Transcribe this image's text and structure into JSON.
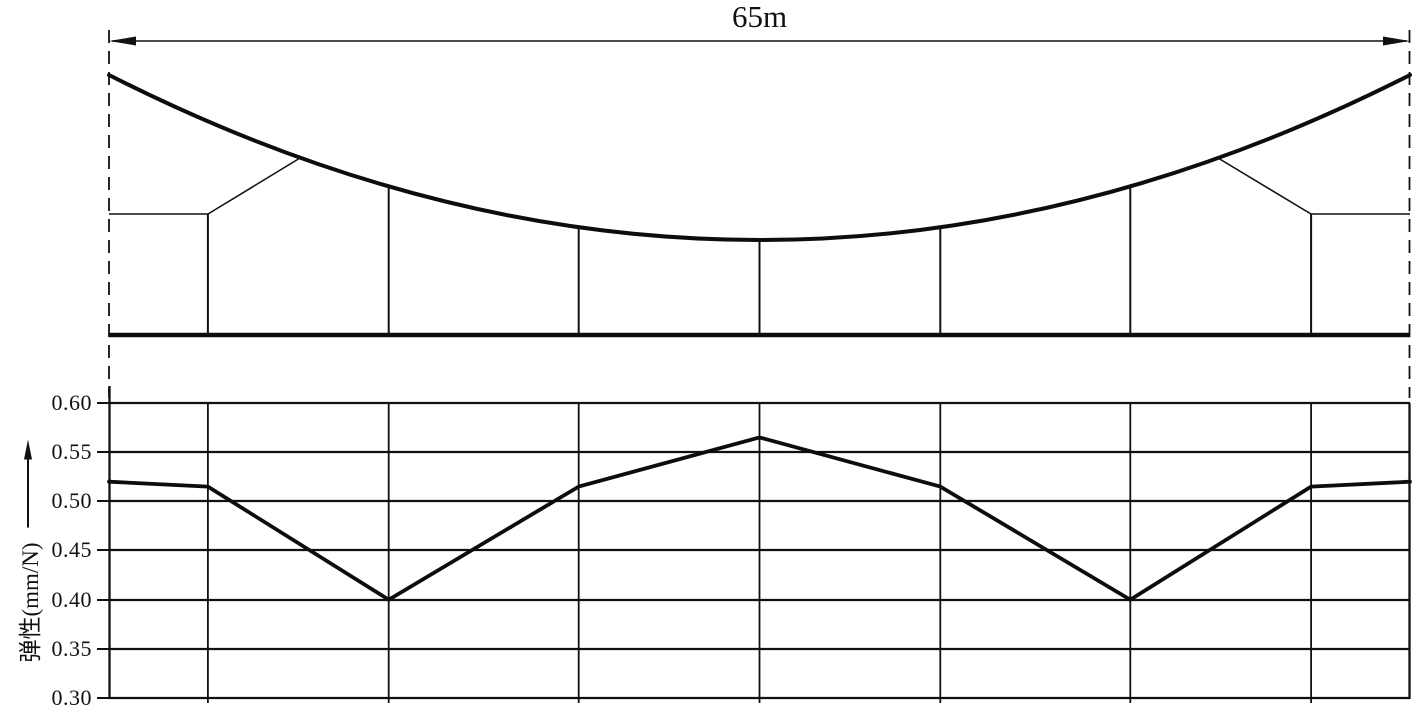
{
  "diagram": {
    "span_label": "65m",
    "dropper_fractions": [
      0.215,
      0.361,
      0.5,
      0.639,
      0.785
    ],
    "stitch_dropper_fractions": [
      0.076,
      0.924
    ]
  },
  "chart_data": {
    "type": "line",
    "title": "",
    "xlabel": "",
    "ylabel": "弹性(mm/N)",
    "ylim": [
      0.3,
      0.6
    ],
    "ytick_labels": [
      "0.60",
      "0.55",
      "0.50",
      "0.45",
      "0.40",
      "0.35",
      "0.30"
    ],
    "x_fraction_of_span": [
      0,
      0.076,
      0.215,
      0.361,
      0.5,
      0.639,
      0.785,
      0.924,
      1
    ],
    "series": [
      {
        "name": "elasticity-along-span",
        "values": [
          0.52,
          0.515,
          0.4,
          0.515,
          0.565,
          0.515,
          0.4,
          0.515,
          0.52
        ]
      }
    ],
    "grid": true,
    "legend": false,
    "line_color": "#0d0d0d"
  }
}
